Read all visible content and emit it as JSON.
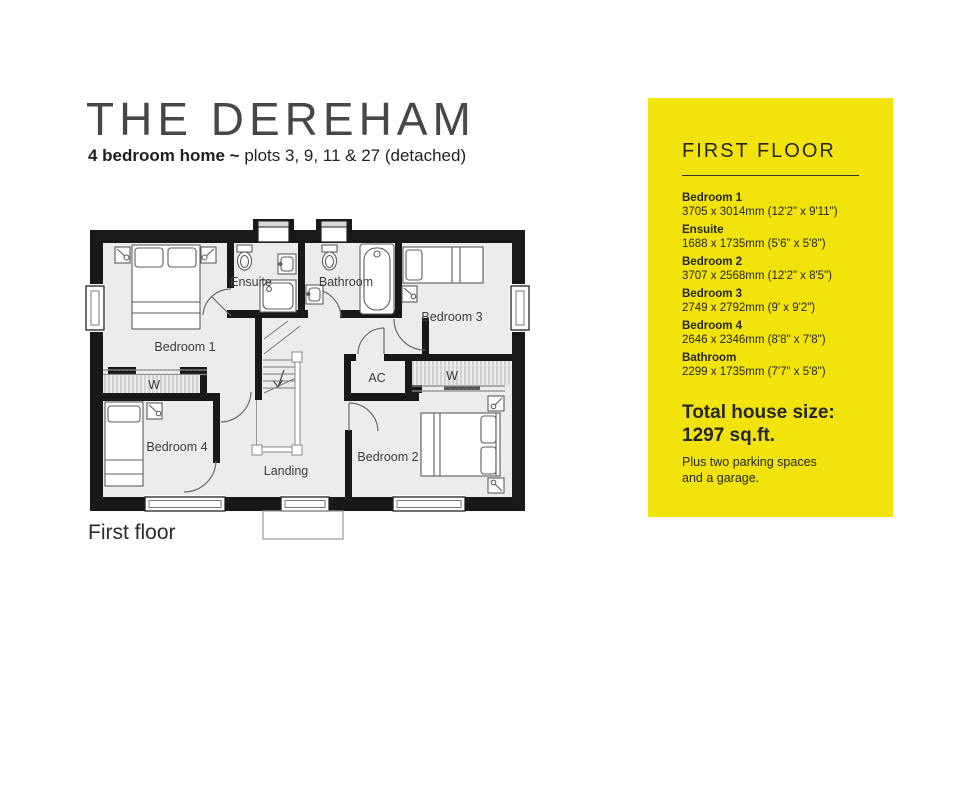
{
  "header": {
    "title": "THE DEREHAM",
    "subtitle_bold": "4 bedroom home ~",
    "subtitle_rest": " plots 3, 9, 11 & 27 (detached)"
  },
  "plan": {
    "caption": "First floor",
    "labels": {
      "bedroom1": "Bedroom 1",
      "bedroom2": "Bedroom 2",
      "bedroom3": "Bedroom 3",
      "bedroom4": "Bedroom 4",
      "ensuite": "Ensuite",
      "bathroom": "Bathroom",
      "landing": "Landing",
      "ac": "AC",
      "wardrobe_left": "W",
      "wardrobe_right": "W"
    }
  },
  "panel": {
    "heading": "FIRST FLOOR",
    "rooms": [
      {
        "name": "Bedroom 1",
        "dims": "3705 x 3014mm (12'2\" x 9'11\")"
      },
      {
        "name": "Ensuite",
        "dims": "1688 x 1735mm (5'6\" x 5'8\")"
      },
      {
        "name": "Bedroom 2",
        "dims": "3707 x 2568mm (12'2\" x 8'5\")"
      },
      {
        "name": "Bedroom 3",
        "dims": "2749 x 2792mm (9' x 9'2\")"
      },
      {
        "name": "Bedroom 4",
        "dims": "2646 x 2346mm (8'8\" x 7'8\")"
      },
      {
        "name": "Bathroom",
        "dims": "2299 x 1735mm (7'7\" x 5'8\")"
      }
    ],
    "total_label": "Total house size:",
    "total_value": "1297 sq.ft.",
    "note": "Plus two parking spaces and a garage."
  },
  "colors": {
    "panel_yellow": "#F2E30D",
    "wall": "#181818",
    "floor": "#ECECEC",
    "text_dark": "#262626"
  }
}
